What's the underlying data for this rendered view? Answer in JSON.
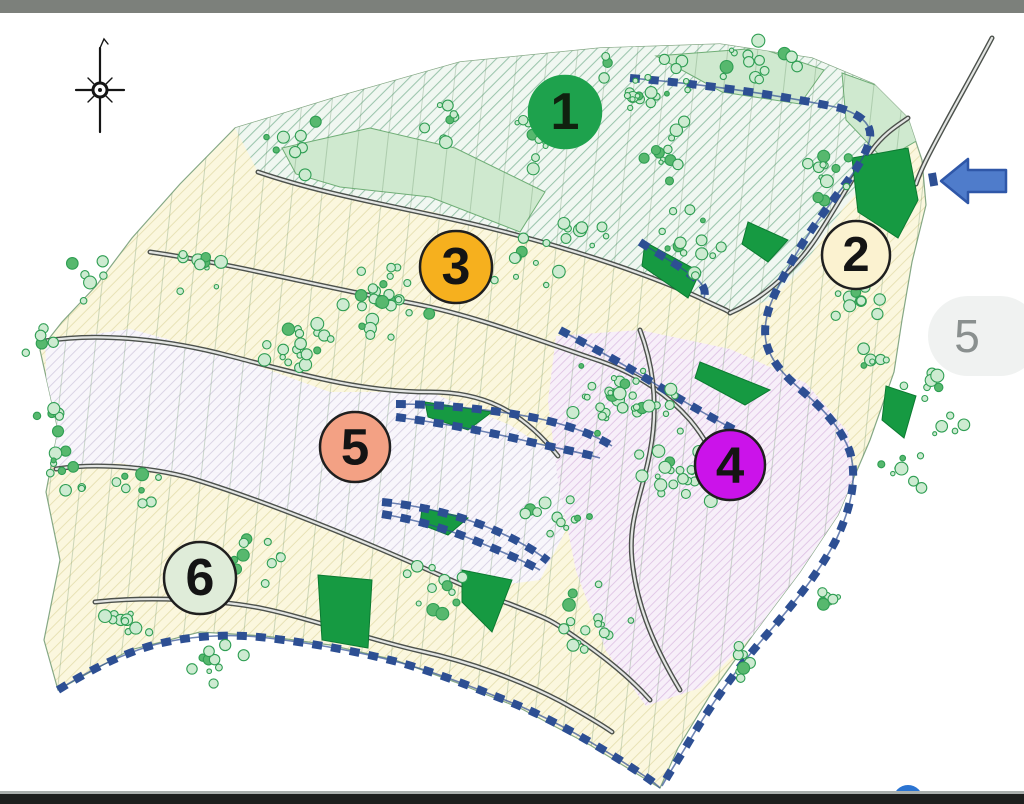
{
  "viewer": {
    "top_bar_color": "#7c807b",
    "bottom_bar_color": "#1d1e1d",
    "separator_color": "#a9aeac",
    "fab_color": "#2b74d2",
    "page_indicator": {
      "value": "5",
      "bg": "#f0f2f1",
      "text_color": "#8a908f"
    }
  },
  "icons": {
    "compass": "north-arrow-icon",
    "annotation": "arrow-left-icon",
    "fab": "floating-circle-button"
  },
  "map": {
    "background": "#ffffff",
    "zone_markers": [
      {
        "label": "1",
        "x": 565,
        "y": 112,
        "r": 36,
        "fill": "#1ea24d",
        "border": "#1ea24d",
        "text": "#10210f"
      },
      {
        "label": "2",
        "x": 856,
        "y": 255,
        "r": 34,
        "fill": "#fbf2d0",
        "border": "#1f1f1f",
        "text": "#141414"
      },
      {
        "label": "3",
        "x": 456,
        "y": 267,
        "r": 36,
        "fill": "#f6b01e",
        "border": "#1f1f1f",
        "text": "#141414"
      },
      {
        "label": "4",
        "x": 730,
        "y": 465,
        "r": 35,
        "fill": "#cb13ea",
        "border": "#1f1f1f",
        "text": "#141414"
      },
      {
        "label": "5",
        "x": 355,
        "y": 447,
        "r": 35,
        "fill": "#f3a184",
        "border": "#1f1f1f",
        "text": "#141414"
      },
      {
        "label": "6",
        "x": 200,
        "y": 578,
        "r": 36,
        "fill": "#dfecd9",
        "border": "#1f1f1f",
        "text": "#141414"
      }
    ],
    "colors": {
      "boundary_blue": "#2d4f93",
      "forest_green": "#169a42",
      "mint": "#cfe9cf",
      "road_outline": "#4c514c",
      "road_fill": "#e3e5e3",
      "tree_stroke": "#2f9e53",
      "tree_fill": "#cdebd1",
      "hatch_teal": "#9cc5ad",
      "hatch_cream_line": "#e8e2b6",
      "hatch_lavender": "#d7d0e3",
      "hatch_pink": "#dec2e4",
      "annotation_arrow": "#4f7ccb"
    }
  }
}
